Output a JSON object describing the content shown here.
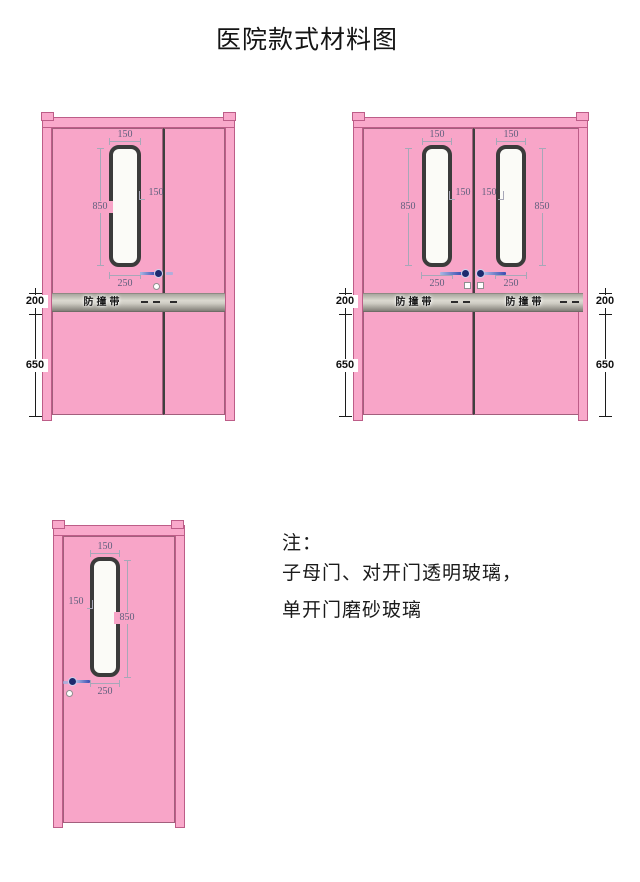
{
  "title": "医院款式材料图",
  "doors": {
    "mother_child": {
      "window_width": "150",
      "window_height": "850",
      "window_side_offset": "150",
      "window_bottom_offset": "250",
      "band_label": "防撞带",
      "band_height": "200",
      "below_band_height": "650"
    },
    "double": {
      "left_window_width": "150",
      "left_window_height": "850",
      "left_center_offset": "150",
      "left_window_bottom_offset": "250",
      "right_window_width": "150",
      "right_window_height": "850",
      "right_center_offset": "150",
      "right_window_bottom_offset": "250",
      "band_label_left": "防撞带",
      "band_label_right": "防撞带",
      "band_height_left": "200",
      "below_band_height_left": "650",
      "band_height_right": "200",
      "below_band_height_right": "650"
    },
    "single": {
      "window_width": "150",
      "window_side_offset": "150",
      "window_height": "850",
      "window_bottom_offset": "250"
    }
  },
  "note": {
    "heading": "注：",
    "line1": "子母门、对开门透明玻璃，",
    "line2": "单开门磨砂玻璃"
  },
  "colors": {
    "door_pink": "#f8a5c8",
    "frame_outline": "#bd5d88",
    "window_frame": "#3b3b3b",
    "glass_white": "#fbfbf7",
    "band_metal": "#c9c7bf",
    "hardware_blue": "#2c3e9e",
    "dimension_text": "#5f5f7d",
    "outer_dimension_text": "#141414"
  }
}
